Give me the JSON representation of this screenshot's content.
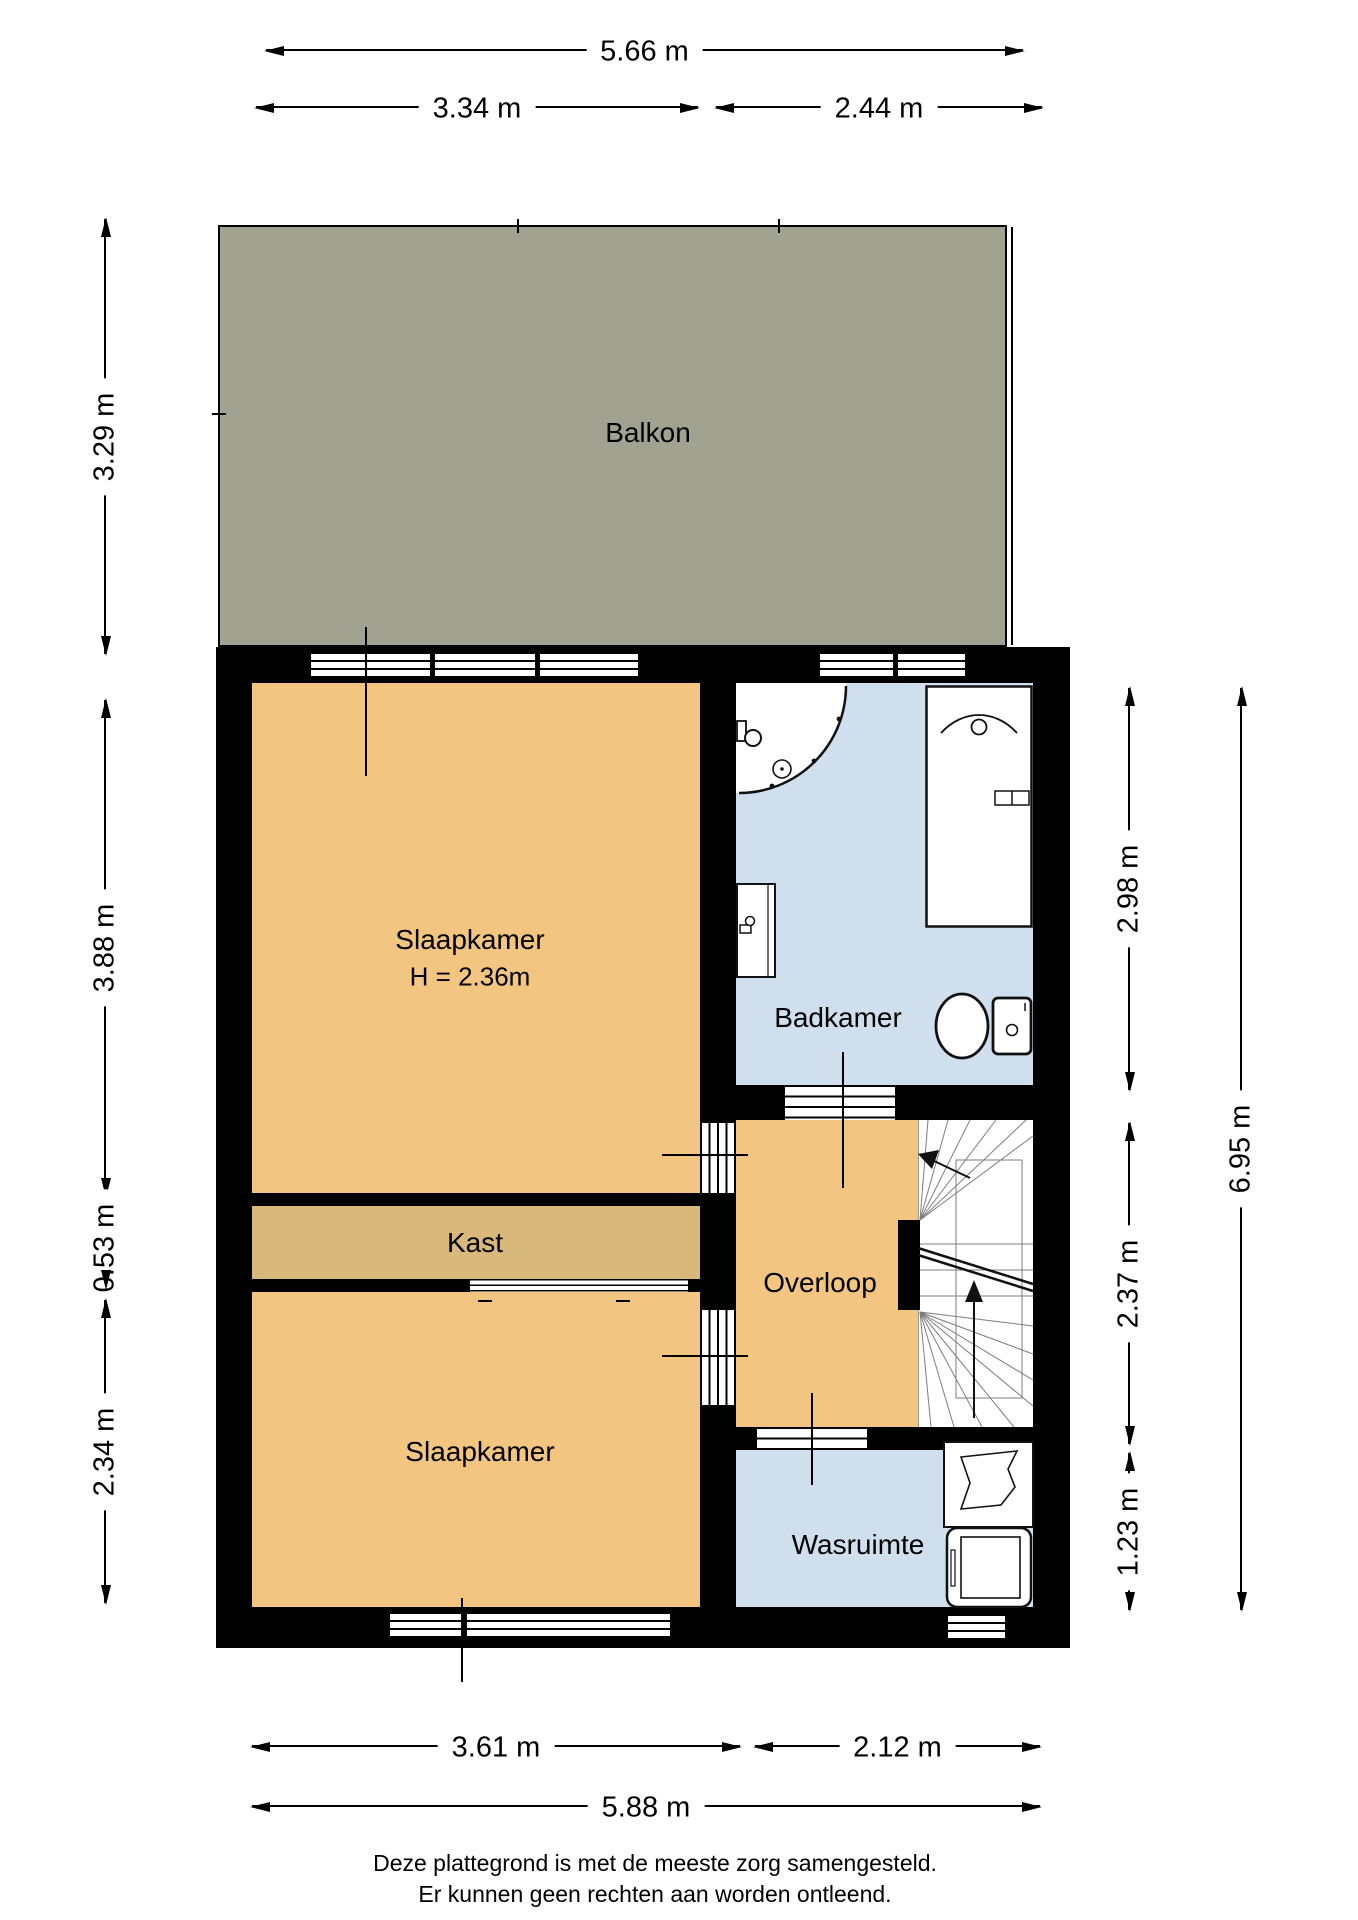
{
  "plan": {
    "rooms": {
      "balkon": {
        "label": "Balkon"
      },
      "slaapkamer_boven": {
        "label": "Slaapkamer",
        "height_note": "H = 2.36m"
      },
      "badkamer": {
        "label": "Badkamer"
      },
      "kast": {
        "label": "Kast"
      },
      "overloop": {
        "label": "Overloop"
      },
      "slaapkamer_beneden": {
        "label": "Slaapkamer"
      },
      "wasruimte": {
        "label": "Wasruimte"
      }
    },
    "fixtures": {
      "shower": "shower-enclosure-quarter-circle",
      "washbasin": "bathroom-washbasin",
      "bathtub": "bathtub",
      "toilet": "toilet-with-cistern",
      "stairs": "winder-staircase-up",
      "laundry_sink": "laundry-sink",
      "washing_machine": "washing-machine"
    },
    "colors": {
      "wall": "#000000",
      "floor_orange": "#f2c680",
      "closet_tan": "#d9b87c",
      "wet_blue": "#cfdfee",
      "balcony_gray": "#a2a290",
      "stair_line": "#7d7d7d"
    }
  },
  "dimensions": {
    "top": {
      "total": "5.66 m",
      "left": "3.34 m",
      "right": "2.44 m"
    },
    "left": {
      "balcony": "3.29 m",
      "bedroom": "3.88 m",
      "closet": "0.53 m",
      "bedroom2": "2.34 m"
    },
    "right": {
      "bathroom": "2.98 m",
      "landing": "2.37 m",
      "laundry": "1.23 m",
      "total": "6.95 m"
    },
    "bottom": {
      "bedroom": "3.61 m",
      "laundry": "2.12 m",
      "total": "5.88 m"
    }
  },
  "footer": {
    "line1": "Deze plattegrond is met de meeste zorg samengesteld.",
    "line2": "Er kunnen geen rechten aan worden ontleend."
  }
}
